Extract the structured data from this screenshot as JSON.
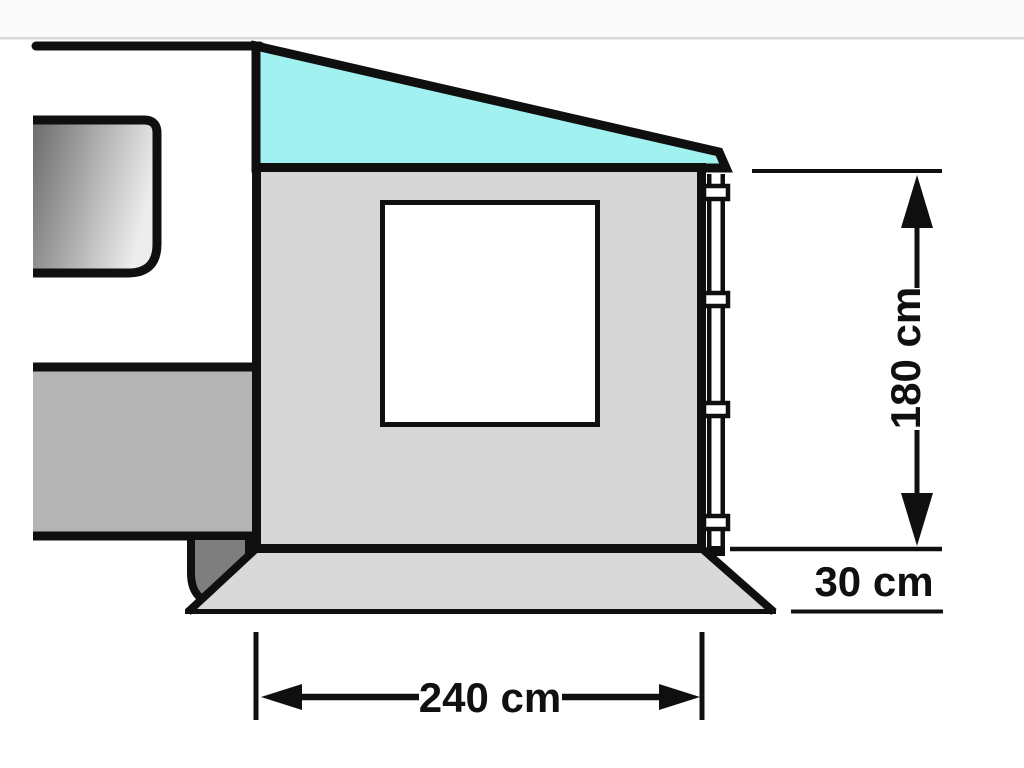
{
  "diagram": {
    "name": "awning-dimension-diagram",
    "labels": {
      "height": "180 cm",
      "ground_clearance": "30 cm",
      "width": "240 cm"
    }
  },
  "colors": {
    "line": "#0f0f0f",
    "top_band": "#fbfafa",
    "divider": "#d9d8d8",
    "roof": "#a0f1ef",
    "panel": "#d6d6d6",
    "skirt": "#d9d9d9",
    "caravan_band": "#b4b4b4",
    "mudflap": "#7e7e7e",
    "caravan_window_dark": "#6b6b6b",
    "caravan_window_light": "#ededed",
    "window_white": "#ffffff"
  }
}
